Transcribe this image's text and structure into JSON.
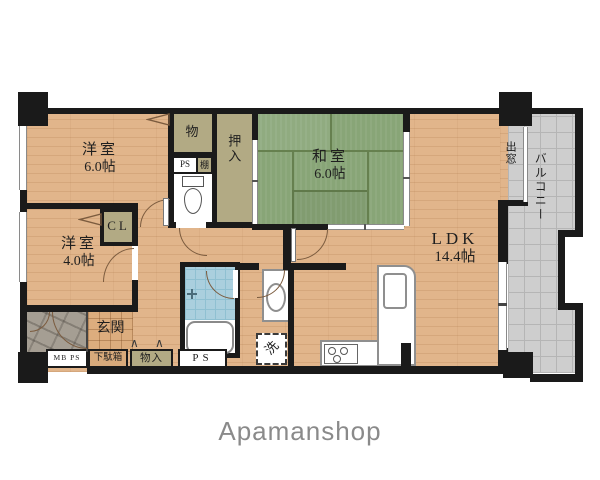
{
  "logo": {
    "text": "Apamanshop"
  },
  "rooms": {
    "western_6": {
      "name": "洋室",
      "size": "6.0帖"
    },
    "western_4": {
      "name": "洋室",
      "size": "4.0帖"
    },
    "japanese_6": {
      "name": "和室",
      "size": "6.0帖"
    },
    "ldk": {
      "name": "LDK",
      "size": "14.4帖"
    },
    "storage_mono": {
      "label": "物"
    },
    "oshiire": {
      "label": "押入"
    },
    "closet_cl": {
      "label": "CL"
    },
    "genkan": {
      "label": "玄関"
    },
    "ps_upper": {
      "label": "PS"
    },
    "shelf": {
      "label": "棚"
    },
    "mb_ps": {
      "label": "MB PS"
    },
    "getabako": {
      "label": "下駄箱"
    },
    "monoire": {
      "label": "物入"
    },
    "ps_lower": {
      "label": "PS"
    },
    "laundry": {
      "label": "洗"
    },
    "bay_window": {
      "label": "出窓"
    },
    "balcony": {
      "label": "バルコニー"
    }
  },
  "colors": {
    "wall": "#1a1a1a",
    "wood_floor": "#e1b58b",
    "tatami": "#88a577",
    "closet": "#b2aa84",
    "balcony": "#cecece",
    "bathroom": "#aacfde",
    "door_arc": "#7b5b3e",
    "logo_gray": "#8a8a8a"
  }
}
